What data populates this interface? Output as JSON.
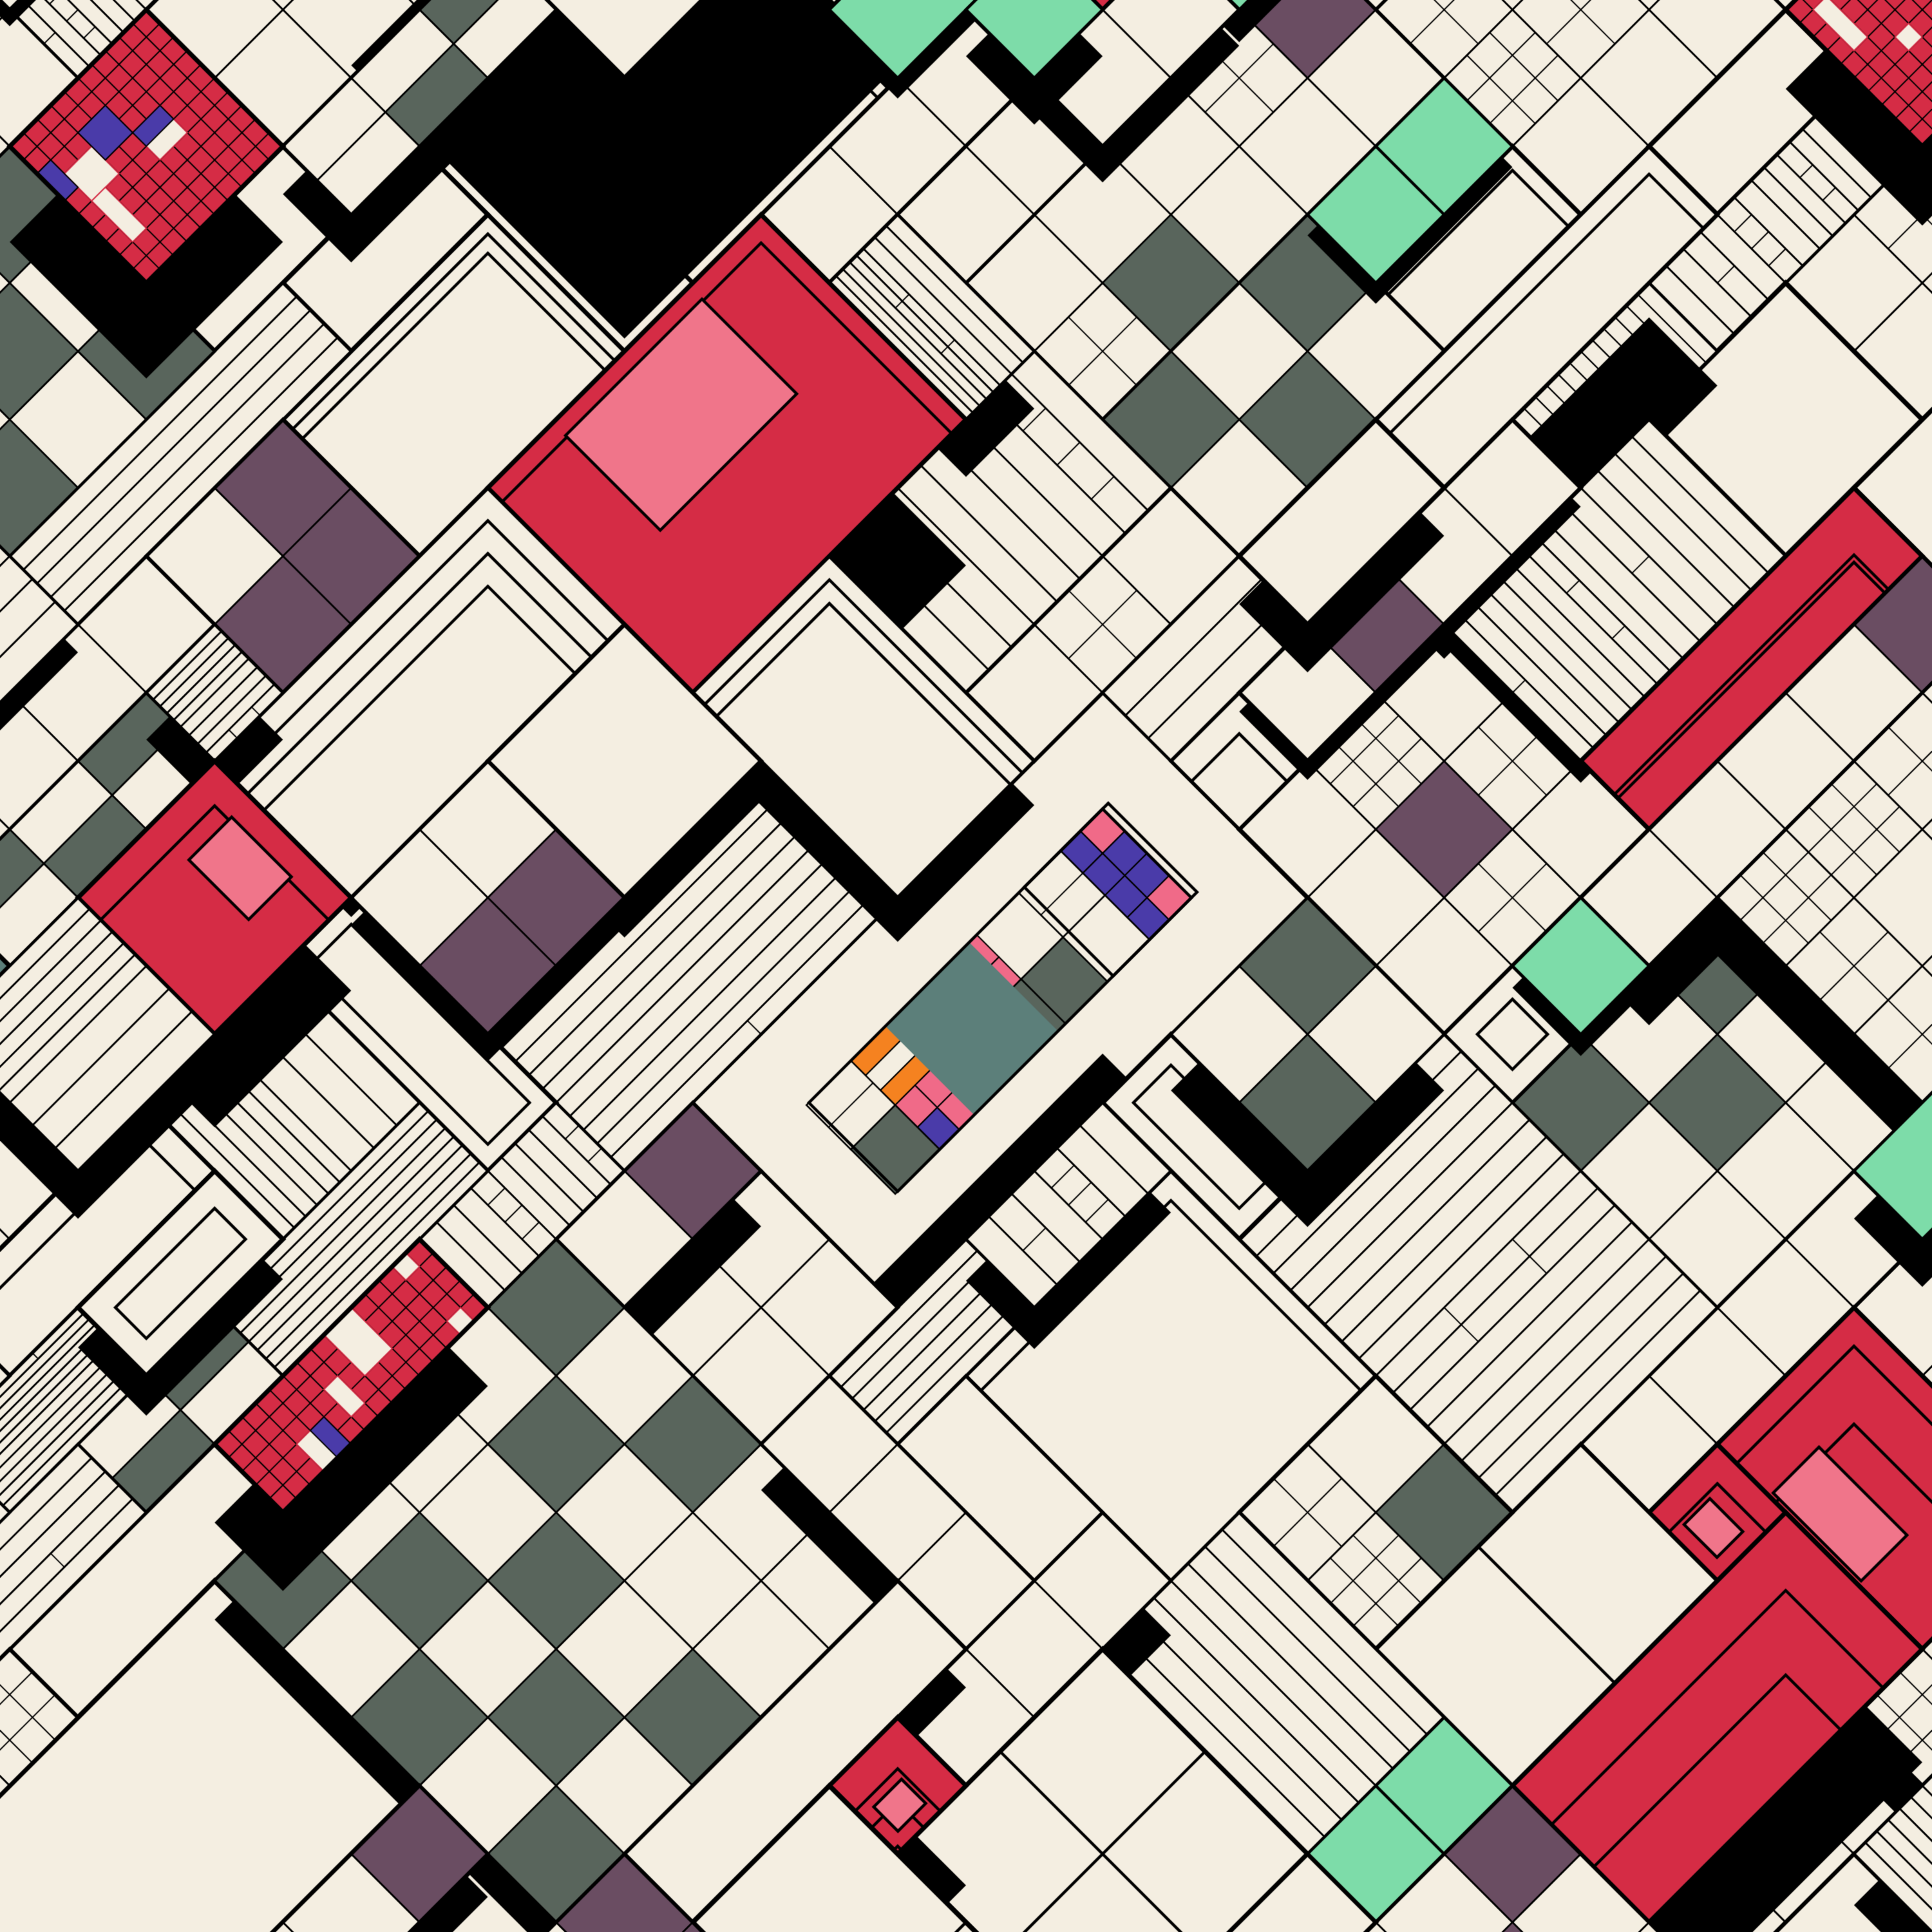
{
  "artwork": {
    "kind": "generative-isometric-subdivision",
    "size": 3000,
    "rotation_deg": 45,
    "unit": 150,
    "extent_cells": 17,
    "seed": 1337707,
    "background": "#F4EEE1",
    "palette": {
      "cream": "#F4EEE1",
      "black": "#000000",
      "red": "#D52C45",
      "rose": "#F0758A",
      "mauve": "#B06B80",
      "mint": "#7DDCA9",
      "indigo": "#4A3BA9",
      "plum": "#6A4D62",
      "slate": "#59655C",
      "teal": "#5C7F7A",
      "orange": "#F58220",
      "pink": "#F06A88"
    },
    "line": {
      "outer": 7,
      "mid": 4.5,
      "fine": 2.6,
      "micro": 2.0
    },
    "styles": [
      {
        "name": "plain",
        "weight": 0.25
      },
      {
        "name": "grid",
        "weight": 0.2
      },
      {
        "name": "strips",
        "weight": 0.17
      },
      {
        "name": "checker",
        "weight": 0.07
      },
      {
        "name": "plumrun",
        "weight": 0.09
      },
      {
        "name": "mint",
        "weight": 0.07
      },
      {
        "name": "redgrid",
        "weight": 0.06
      },
      {
        "name": "bigcolor",
        "weight": 0.06
      },
      {
        "name": "fine",
        "weight": 0.03
      }
    ],
    "panel_size_weights": {
      "1": 0.16,
      "2": 0.34,
      "3": 0.28,
      "4": 0.15,
      "5": 0.07
    },
    "raised": {
      "probability": 0.3,
      "min_drop": 25,
      "max_drop": 95
    },
    "mega_shadow": {
      "probability": 0.045,
      "min_drop": 180,
      "max_drop": 420
    },
    "redgrid": {
      "cell_div": 5,
      "holes_min": 2,
      "holes_max": 5,
      "indigo_min": 1,
      "indigo_max": 3,
      "raised_probability": 0.8,
      "min_drop": 60,
      "max_drop": 170
    },
    "mint_panel": {
      "raised_probability": 0.95,
      "min_drop": 30,
      "max_drop": 75
    },
    "bigcolor": {
      "red_probability": 0.72,
      "raised_probability": 0.6,
      "min_drop": 80,
      "max_drop": 260
    },
    "jewel": {
      "u0": -1,
      "v0": -3,
      "cols": 3,
      "rows": 6,
      "drop": 380,
      "margin_units": 0.85,
      "cell_units": 0.55,
      "cell_weights": {
        "teal": 0.26,
        "cream": 0.22,
        "indigo": 0.14,
        "orangeStrip": 0.12,
        "slate": 0.09,
        "pinkChk": 0.09,
        "black": 0.04,
        "plum": 0.04
      }
    }
  }
}
